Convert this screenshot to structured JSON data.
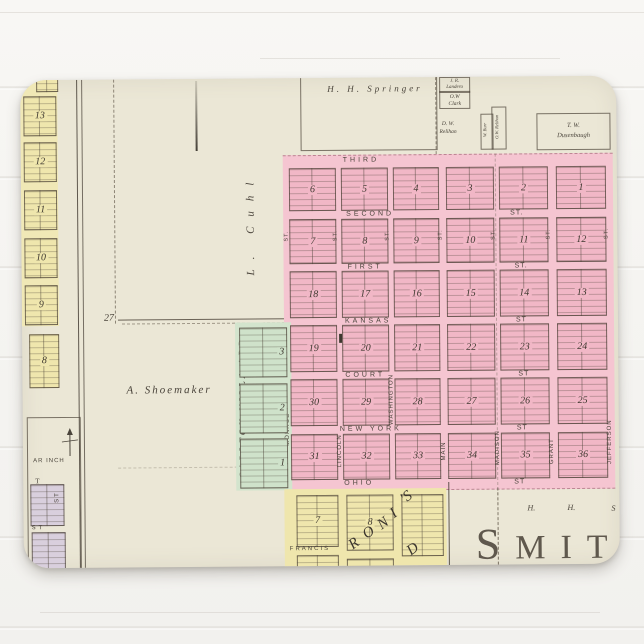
{
  "palette": {
    "paper": "#ebe7d6",
    "pink_block": "#f1b7c6",
    "pink_street": "#f6c9d4",
    "yellow": "#efe6ad",
    "green": "#cfe2ca",
    "lavender": "#d9cfdd",
    "ink": "#4a443b",
    "wall": "#f5f4f1"
  },
  "map": {
    "town_name_partial": "SMITH",
    "owners": {
      "springer": "H. H. Springer",
      "landero1": "J. R.",
      "landero2": "Landero",
      "clark1": "O.W",
      "clark2": "Clark",
      "relihan1": "D. W.",
      "relihan2": "Relihan",
      "burr": "W. Burr",
      "relihan_v": "O.W. Relihan",
      "dusen1": "T. W.",
      "dusen2": "Dusenbaugh",
      "shoemaker": "A. Shoemaker",
      "cuhl": "L. Cuhl",
      "right1": "H.",
      "right2": "H.",
      "right3": "S"
    },
    "section_number": "27",
    "scale_text": "AR INCH",
    "street_abbr": "ST.",
    "mill_label": "M.Co.",
    "streets_horizontal": [
      {
        "name": "THIRD",
        "st": ""
      },
      {
        "name": "SECOND",
        "st": "ST."
      },
      {
        "name": "FIRST",
        "st": "ST."
      },
      {
        "name": "KANSAS",
        "st": "ST"
      },
      {
        "name": "COURT",
        "st": "ST"
      },
      {
        "name": "NEW YORK",
        "st": "ST"
      },
      {
        "name": "OHIO",
        "st": "ST"
      }
    ],
    "streets_vertical": [
      "MONROE",
      "LINCOLN",
      "WASHINGTON",
      "MAIN",
      "MADISON",
      "GRANT",
      "JEFFERSON"
    ],
    "blocks_grid": [
      [
        "6",
        "5",
        "4",
        "3",
        "2",
        "1"
      ],
      [
        "7",
        "8",
        "9",
        "10",
        "11",
        "12"
      ],
      [
        "18",
        "17",
        "16",
        "15",
        "14",
        "13"
      ],
      [
        "19",
        "20",
        "21",
        "22",
        "23",
        "24"
      ],
      [
        "30",
        "29",
        "28",
        "27",
        "26",
        "25"
      ],
      [
        "31",
        "32",
        "33",
        "34",
        "35",
        "36"
      ]
    ],
    "left_strip": {
      "street": "LOCUST",
      "blocks": [
        "13",
        "12",
        "11",
        "10",
        "9"
      ],
      "extra_block": "8",
      "bottom_label_t": "T",
      "bottom_label_st1": "ST",
      "bottom_label_st2": "ST"
    },
    "green_addition": {
      "label": "CARLTON VILLA ADD.",
      "blocks": [
        "3",
        "2",
        "1"
      ]
    },
    "south_addition": {
      "street": "FRANCIS",
      "blocks": [
        "7",
        "8"
      ],
      "script_letters": [
        "R",
        "O",
        "N",
        "I",
        "'S",
        "D"
      ]
    }
  }
}
